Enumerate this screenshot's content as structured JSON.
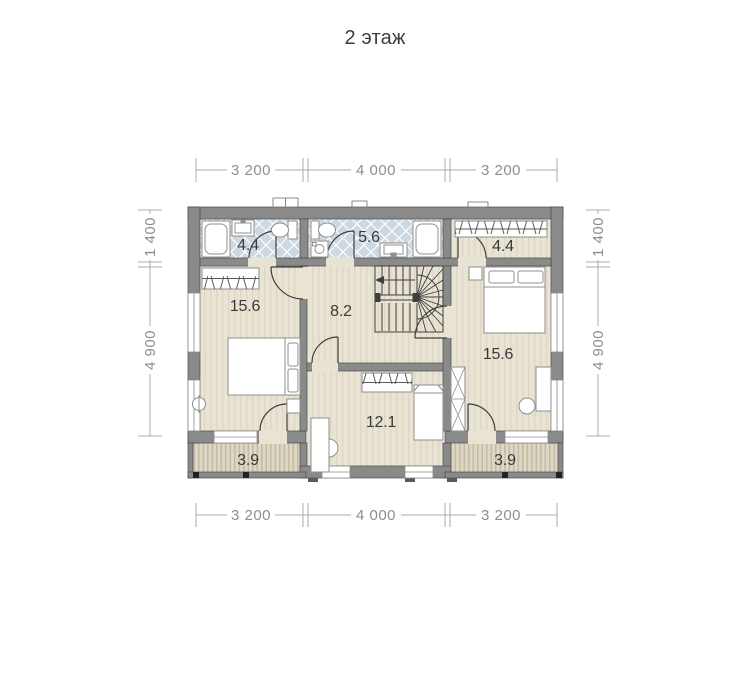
{
  "title": "2 этаж",
  "dimensions": {
    "top": [
      "3 200",
      "4 000",
      "3 200"
    ],
    "bottom": [
      "3 200",
      "4 000",
      "3 200"
    ],
    "left": [
      "1 400",
      "4 900"
    ],
    "right": [
      "1 400",
      "4 900"
    ]
  },
  "rooms": [
    {
      "name": "bathroom-small",
      "area": "4.4"
    },
    {
      "name": "bathroom-large",
      "area": "5.6"
    },
    {
      "name": "dressing-room",
      "area": "4.4"
    },
    {
      "name": "bedroom-left",
      "area": "15.6"
    },
    {
      "name": "hall",
      "area": "8.2"
    },
    {
      "name": "bedroom-right",
      "area": "15.6"
    },
    {
      "name": "room-bottom",
      "area": "12.1"
    },
    {
      "name": "balcony-left",
      "area": "3.9"
    },
    {
      "name": "balcony-right",
      "area": "3.9"
    }
  ],
  "colors": {
    "wall": "#8a8a8a",
    "wall_edge": "#4a4a4a",
    "floor": "#e9e3d3",
    "floor_stripe": "#ded7c5",
    "tile": "#cdd8e1",
    "tile_line": "#ffffff",
    "deck": "#ded7c4",
    "deck_stripe": "#c2bba5",
    "plan_line": "#3f3f3f",
    "dim_line": "#ababab",
    "dim_text": "#8e8e8e",
    "label_text": "#3a3a3a"
  }
}
